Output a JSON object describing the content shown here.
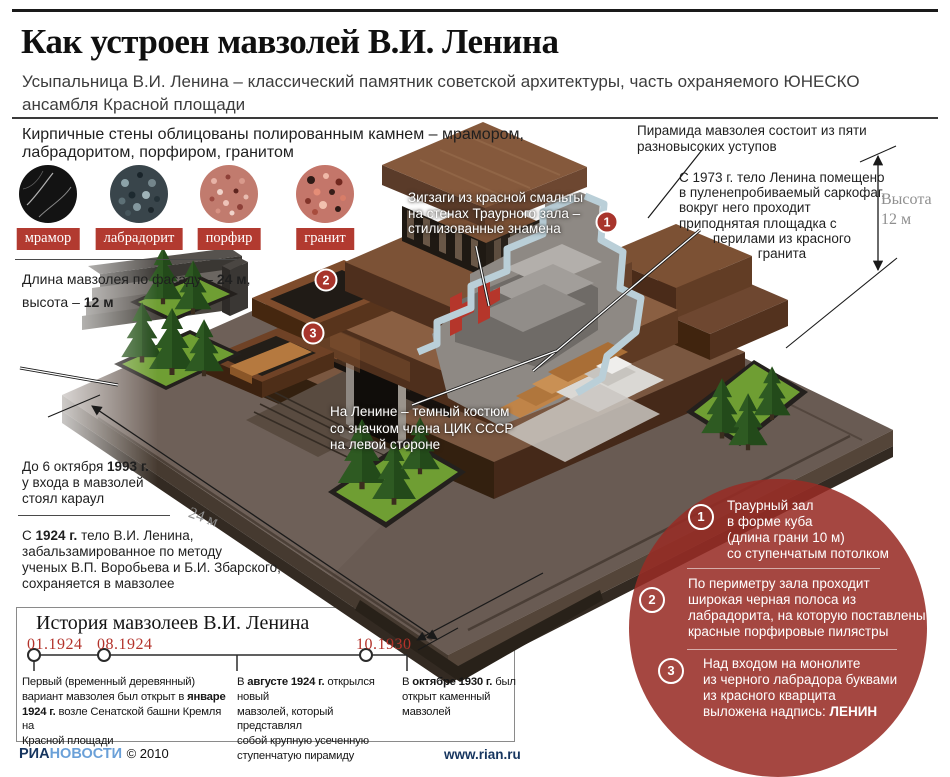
{
  "header": {
    "title": "Как устроен мавзолей В.И. Ленина",
    "subtitle_html": "Усыпальница В.И. Ленина – классический памятник советской архитектуры, часть охраняемого ЮНЕСКО<br>ансамбля Красной площади"
  },
  "materials": {
    "intro_html": "Кирпичные стены облицованы полированным камнем – мрамором,<br>лабрадоритом, порфиром, гранитом",
    "stones": [
      {
        "name": "мрамор"
      },
      {
        "name": "лабрадорит"
      },
      {
        "name": "порфир"
      },
      {
        "name": "гранит"
      }
    ]
  },
  "dimensions": {
    "length_html": "Длина мавзолея по фасаду – <b>24 м</b>,<br>высота – <b>12 м</b>",
    "facade_label": "24 м",
    "height_label_html": "Высота<br>12 м"
  },
  "annotations": {
    "pyramid_html": "Пирамида мавзолея состоит из пяти<br>разновысоких уступов",
    "sarcophagus_html": "С 1973 г. тело Ленина помещено<br>в пуленепробиваемый саркофаг,<br>вокруг него проходит<br>приподнятая площадка с<br><i>перилами из красного<br>гранита</i>",
    "zigzag_html": "Зигзаги из красной смальты<br>на стенах Траурного зала –<br>стилизованные знамена",
    "suit_html": "На Ленине – темный костюм<br>со значком члена ЦИК СССР<br>на левой стороне",
    "guard_html": "До 6 октября <b>1993 г.</b><br>у входа в мавзолей<br>стоял караул",
    "embalmed_html": "С <b>1924 г.</b> тело В.И. Ленина,<br>забальзамированное по методу<br>ученых В.П. Воробьева и Б.И. Збарского,<br>сохраняется в мавзолее",
    "lenin_sign": "ЛЕНИН"
  },
  "hall_facts": [
    {
      "num": "1",
      "html": "Траурный зал<br>в форме куба<br>(длина грани 10 м)<br>со ступенчатым потолком"
    },
    {
      "num": "2",
      "html": "По периметру зала проходит<br>широкая черная полоса из<br>лабрадорита, на которую поставлены<br>красные порфировые пилястры"
    },
    {
      "num": "3",
      "html": "Над входом на монолите<br>из черного лабрадора буквами<br>из красного кварцита<br>выложена надпись: <b>ЛЕНИН</b>"
    }
  ],
  "timeline": {
    "title": "История мавзолеев В.И. Ленина",
    "events": [
      {
        "date": "01.1924",
        "html": "Первый (временный деревянный)<br>вариант мавзолея был открыт в <b>январе<br>1924 г.</b> возле Сенатской башни Кремля на<br>Красной площади"
      },
      {
        "date": "08.1924",
        "html": "В <b>августе 1924 г.</b> открылся новый<br>мавзолей, который представлял<br>собой крупную усеченную<br>ступенчатую пирамиду"
      },
      {
        "date": "10.1930",
        "html": "В <b>октябре 1930 г.</b> был<br>открыт каменный мавзолей"
      }
    ]
  },
  "footer": {
    "agency_bold": "РИА",
    "agency_light": "НОВОСТИ",
    "copyright": "© 2010",
    "site": "www.rian.ru"
  },
  "colors": {
    "accent_red": "#b23a30",
    "marker_red": "#a8352c",
    "circle_red": "rgba(152,44,37,0.87)",
    "date_red": "#b3322a",
    "cut_ribbon_blue": "#bacfd8"
  }
}
